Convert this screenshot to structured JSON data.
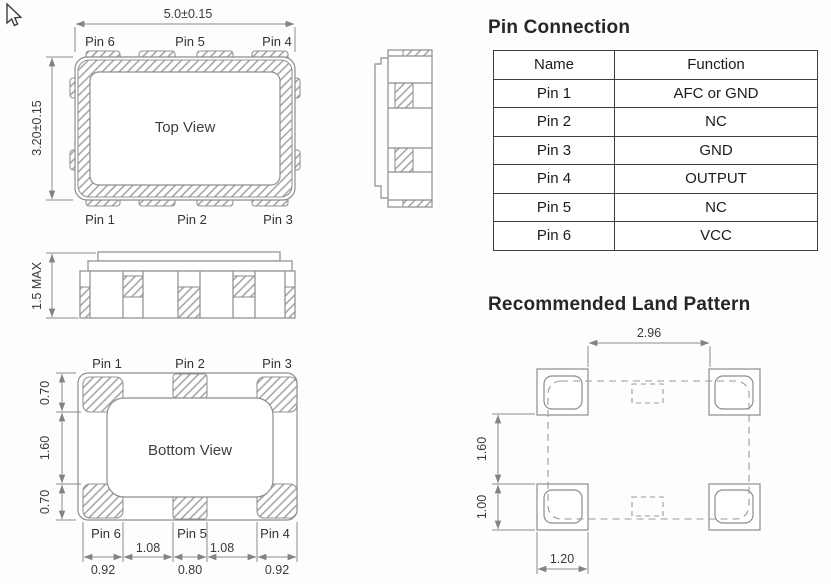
{
  "top_view": {
    "title": "Top View",
    "dim_width": "5.0±0.15",
    "dim_height": "3.20±0.15",
    "pins_top": [
      "Pin 6",
      "Pin 5",
      "Pin 4"
    ],
    "pins_bottom": [
      "Pin 1",
      "Pin 2",
      "Pin 3"
    ]
  },
  "front_view": {
    "dim_height": "1.5 MAX"
  },
  "bottom_view": {
    "title": "Bottom View",
    "pins_top": [
      "Pin 1",
      "Pin 2",
      "Pin 3"
    ],
    "pins_bottom": [
      "Pin 6",
      "Pin 5",
      "Pin 4"
    ],
    "dims_left": [
      "0.70",
      "1.60",
      "0.70"
    ],
    "dims_gap": [
      "1.08",
      "1.08"
    ],
    "dims_pad": [
      "0.92",
      "0.80",
      "0.92"
    ]
  },
  "pin_connection": {
    "title": "Pin Connection",
    "columns": [
      "Name",
      "Function"
    ],
    "rows": [
      [
        "Pin 1",
        "AFC or GND"
      ],
      [
        "Pin 2",
        "NC"
      ],
      [
        "Pin 3",
        "GND"
      ],
      [
        "Pin 4",
        "OUTPUT"
      ],
      [
        "Pin 5",
        "NC"
      ],
      [
        "Pin 6",
        "VCC"
      ]
    ]
  },
  "land_pattern": {
    "title": "Recommended Land Pattern",
    "dim_top": "2.96",
    "dim_left_upper": "1.60",
    "dim_left_lower": "1.00",
    "dim_bottom": "1.20"
  }
}
